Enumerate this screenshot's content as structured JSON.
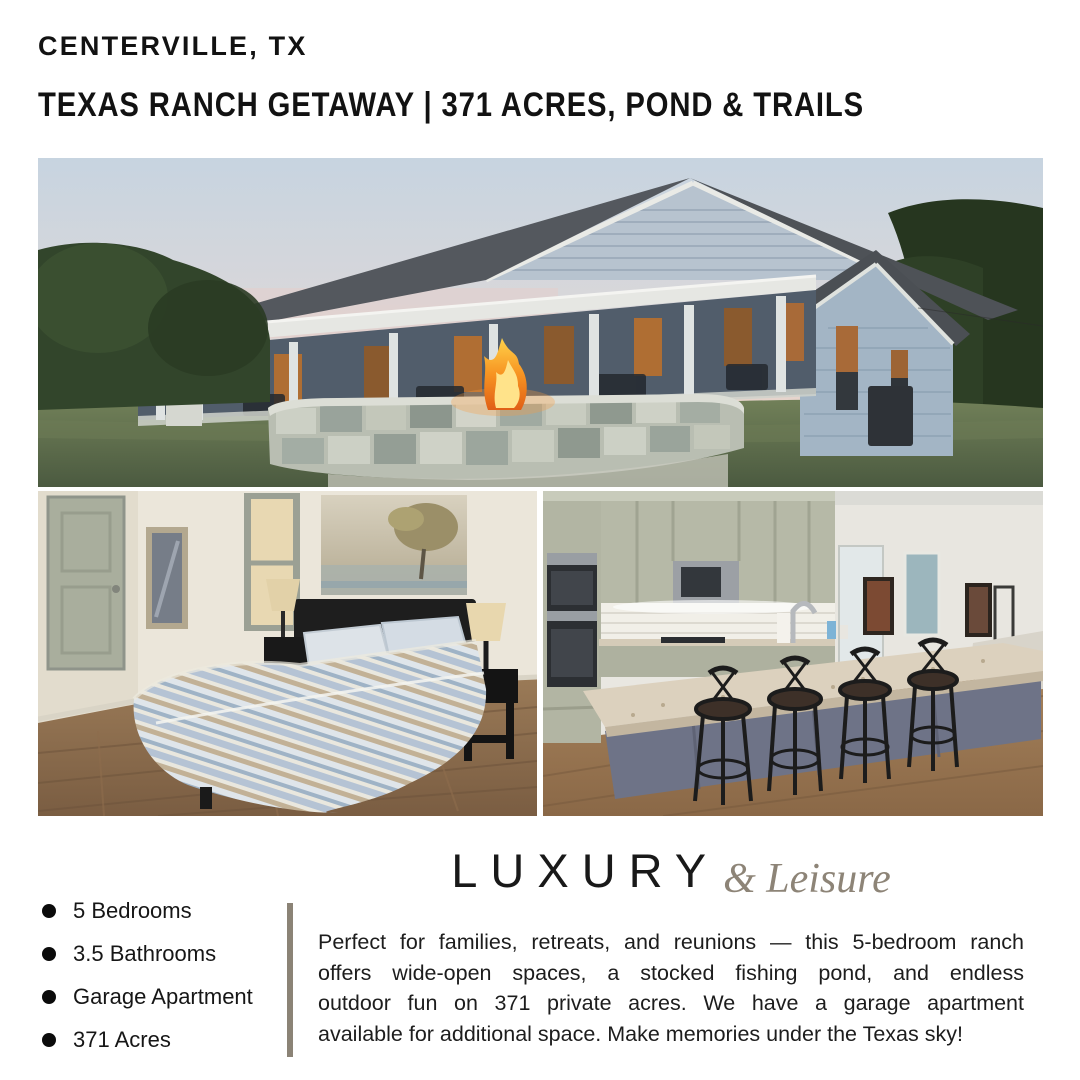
{
  "header": {
    "location": "CENTERVILLE, TX",
    "title": "TEXAS RANCH GETAWAY | 371 ACRES, POND & TRAILS"
  },
  "brand": {
    "word": "LUXURY",
    "script_word": "& Leisure",
    "accent_color": "#8d8477"
  },
  "features": {
    "items": [
      "5 Bedrooms",
      "3.5 Bathrooms",
      "Garage Apartment",
      "371 Acres"
    ]
  },
  "description": {
    "lines": [
      "Perfect for families, retreats, and reunions — this 5-bedroom ranch",
      "offers wide-open spaces, a stocked fishing pond, and endless",
      "outdoor fun on 371 private acres. We have a garage apartment",
      "available for additional space. Make memories under the Texas sky!"
    ]
  },
  "colors": {
    "divider": "#8b8376",
    "headline_text": "#121212",
    "body_text": "#1d1d1d"
  }
}
